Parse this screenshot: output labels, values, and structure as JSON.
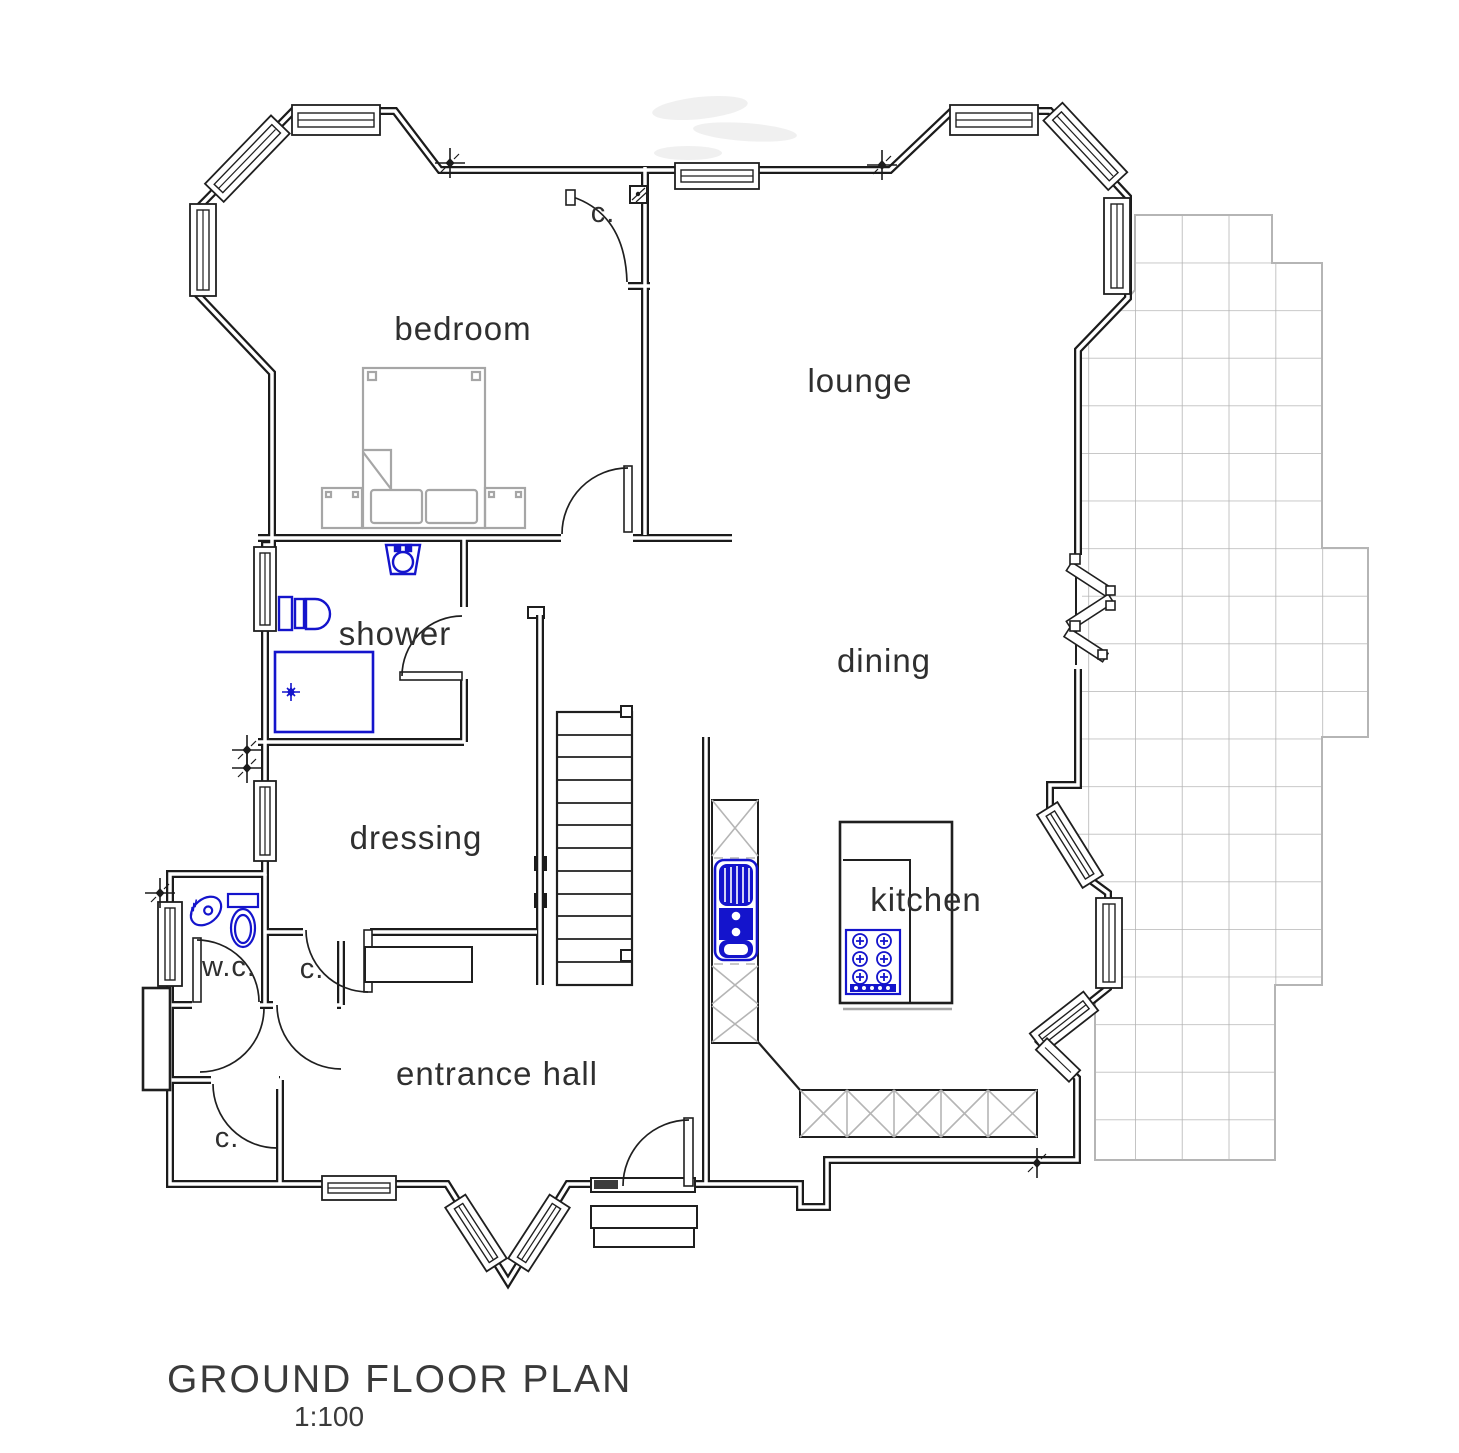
{
  "title": {
    "text": "GROUND FLOOR PLAN",
    "scale": "1:100"
  },
  "labels": {
    "bedroom": "bedroom",
    "closet_top": "c.",
    "lounge": "lounge",
    "shower": "shower",
    "dining": "dining",
    "dressing": "dressing",
    "kitchen": "kitchen",
    "wc": "w.c.",
    "closet_mid": "c.",
    "entrance_hall": "entrance hall",
    "closet_bottom": "c."
  },
  "colors": {
    "walls": "#1b1b1b",
    "fixtures_blue": "#1414cc",
    "furniture_gray": "#a6a6a6",
    "tile_gray": "#b5b5b5",
    "text": "#2f2f2f",
    "background": "#ffffff"
  },
  "drawing": {
    "type": "architectural floor plan",
    "floor": "ground floor"
  }
}
